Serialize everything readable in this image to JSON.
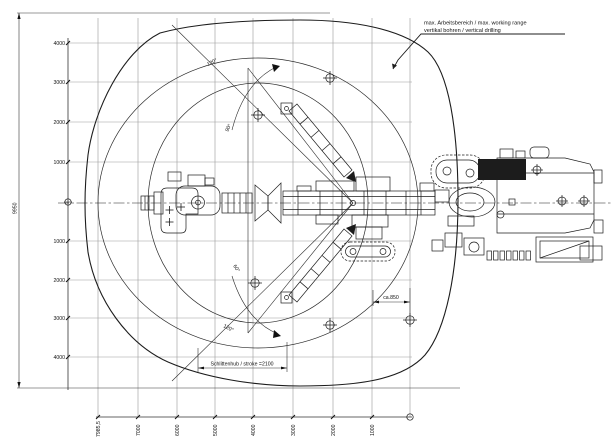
{
  "drawing": {
    "title_annotation": {
      "line1": "max. Arbeitsbereich / max. working range",
      "line2": "vertikal bohren / vertical drilling"
    },
    "dimensions": {
      "overall_height": "9950",
      "stroke": "Schlittenhub / stroke =2100",
      "offset": "ca.850"
    },
    "angles": {
      "top": "120°",
      "upper": "90°",
      "lower": "60°",
      "bottom": "120°"
    },
    "axes": {
      "left": {
        "labels": [
          "4000",
          "3000",
          "2000",
          "1000",
          "1000",
          "2000",
          "3000",
          "4000"
        ]
      },
      "bottom": {
        "labels": [
          "7985,5",
          "7000",
          "6000",
          "5000",
          "4000",
          "3000",
          "2000",
          "1000"
        ]
      }
    },
    "colors": {
      "line": "#1c1c1c",
      "grid": "#999999",
      "background": "#ffffff"
    }
  }
}
